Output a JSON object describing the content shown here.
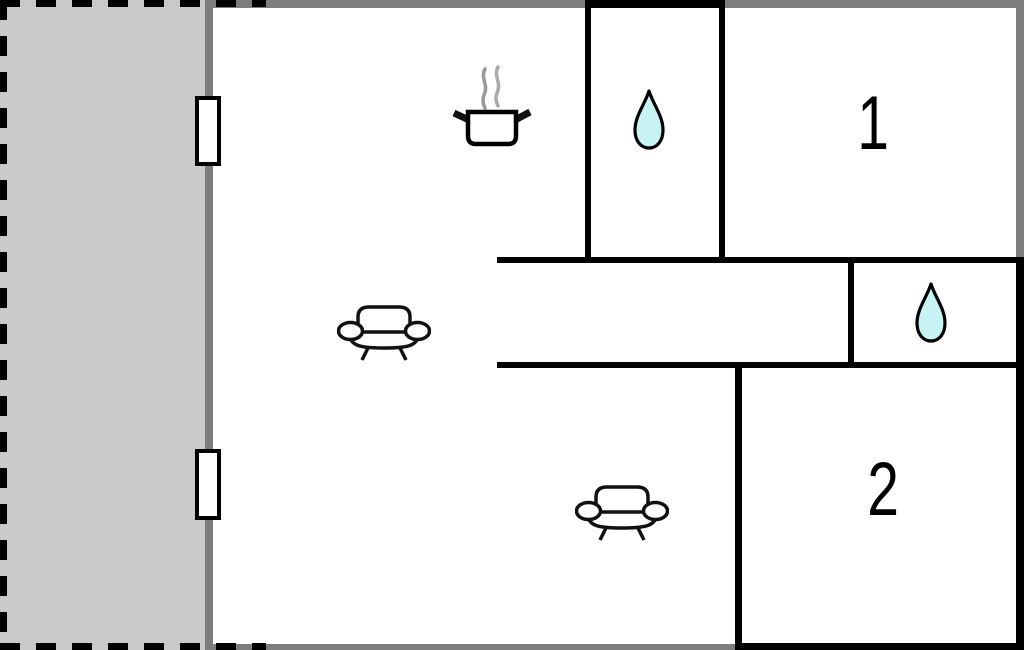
{
  "floorplan": {
    "kind": "holiday-home-floor-plan",
    "rooms": {
      "bedroom_1": {
        "label": "1"
      },
      "bedroom_2": {
        "label": "2"
      }
    },
    "icons": [
      {
        "name": "cooking-pot-icon"
      },
      {
        "name": "water-drop-icon-top"
      },
      {
        "name": "water-drop-icon-right"
      },
      {
        "name": "sofa-icon-living"
      },
      {
        "name": "sofa-icon-lower"
      },
      {
        "name": "window-1"
      },
      {
        "name": "window-2"
      }
    ],
    "colors": {
      "terrace_fill": "#c9c9c9",
      "outer_wall_gray": "#7d7d7d",
      "inner_wall_black": "#000000",
      "water_drop_fill": "#c8f3f5",
      "steam_gray": "#999999",
      "background": "#ffffff"
    }
  }
}
